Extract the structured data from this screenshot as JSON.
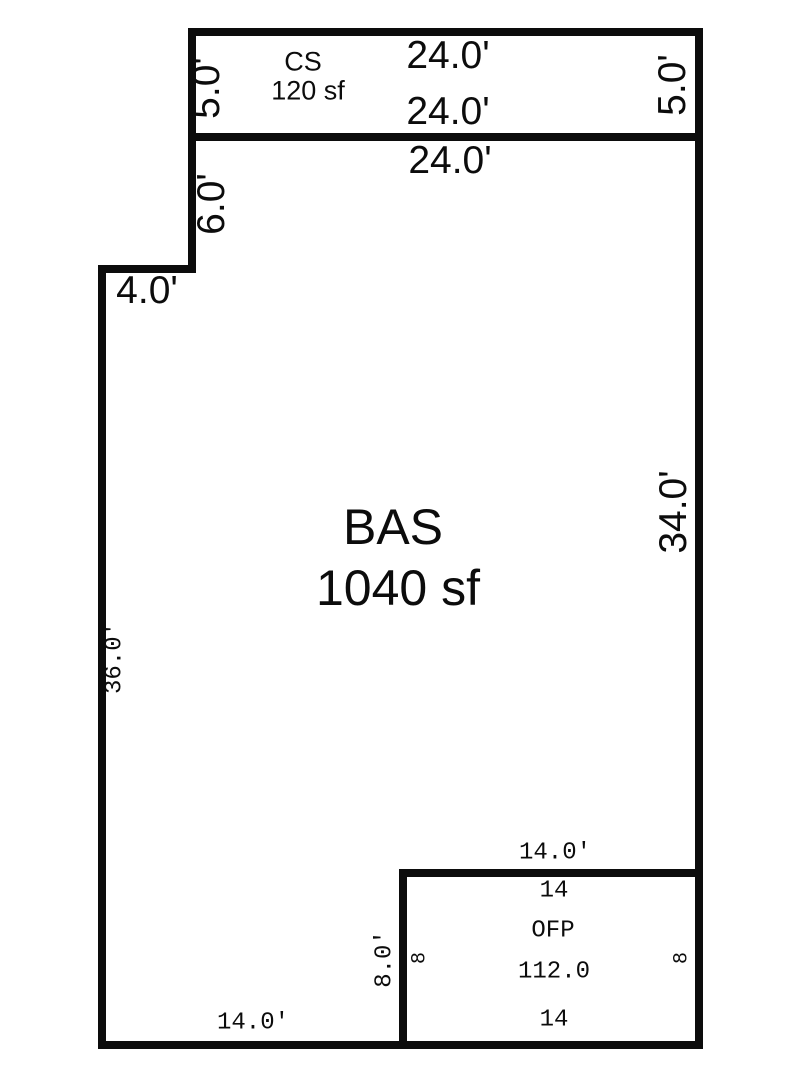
{
  "sketch": {
    "areas": {
      "cs": {
        "code": "CS",
        "size": "120 sf"
      },
      "bas": {
        "code": "BAS",
        "size": "1040 sf"
      },
      "ofp": {
        "code": "OFP",
        "size": "112.0"
      }
    },
    "dims": {
      "cs_top": "24.0'",
      "cs_bottom": "24.0'",
      "cs_left": "5.0'",
      "cs_right": "5.0'",
      "bas_top": "24.0'",
      "bas_left_upper": "6.0'",
      "bas_jog": "4.0'",
      "bas_left": "36.0'",
      "bas_right": "34.0'",
      "bas_bottom_left": "14.0'",
      "ofp_top_outer": "14.0'",
      "ofp_top_inner": "14",
      "ofp_bottom_inner": "14",
      "ofp_left_outer": "8.0'",
      "ofp_left_inner": "8",
      "ofp_right_inner": "8"
    },
    "colors": {
      "wall": "#0c0c0c",
      "text": "#0c0c0c",
      "background": "#ffffff"
    }
  }
}
